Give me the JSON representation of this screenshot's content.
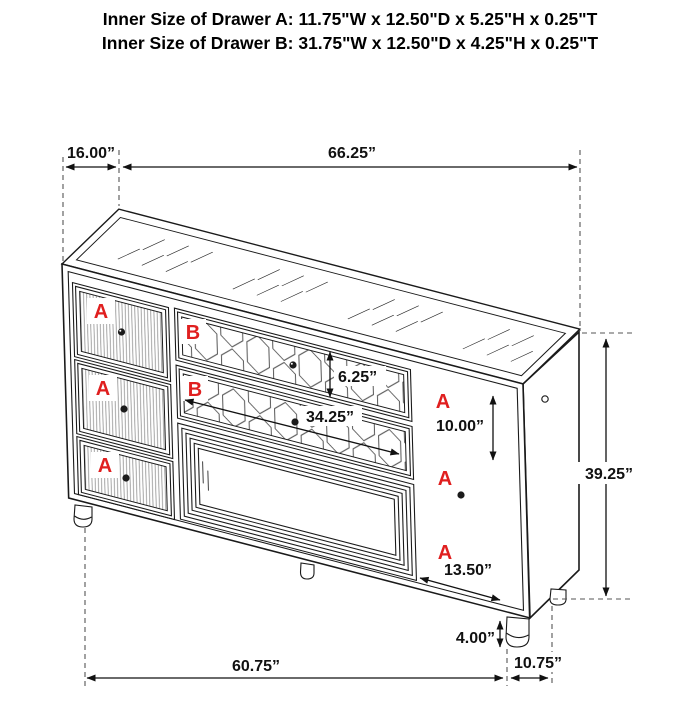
{
  "header": {
    "line1": "Inner Size of Drawer A: 11.75\"W x 12.50\"D x 5.25\"H x 0.25\"T",
    "line2": "Inner Size of Drawer B: 31.75\"W x 12.50\"D x 4.25\"H x 0.25\"T"
  },
  "drawer_labels": {
    "a": "A",
    "b": "B"
  },
  "dimensions": {
    "top_depth": "16.00”",
    "top_width": "66.25”",
    "cabinet_height": "39.25”",
    "drawer_b_front_height": "6.25”",
    "drawer_b_front_width": "34.25”",
    "drawer_a_right_front_height": "10.00”",
    "drawer_a_right_front_width": "13.50”",
    "leg_height": "4.00”",
    "base_width": "60.75”",
    "side_depth": "10.75”"
  },
  "colors": {
    "line": "#1a1a1a",
    "dash": "#555555",
    "label_red": "#e01f1f"
  }
}
